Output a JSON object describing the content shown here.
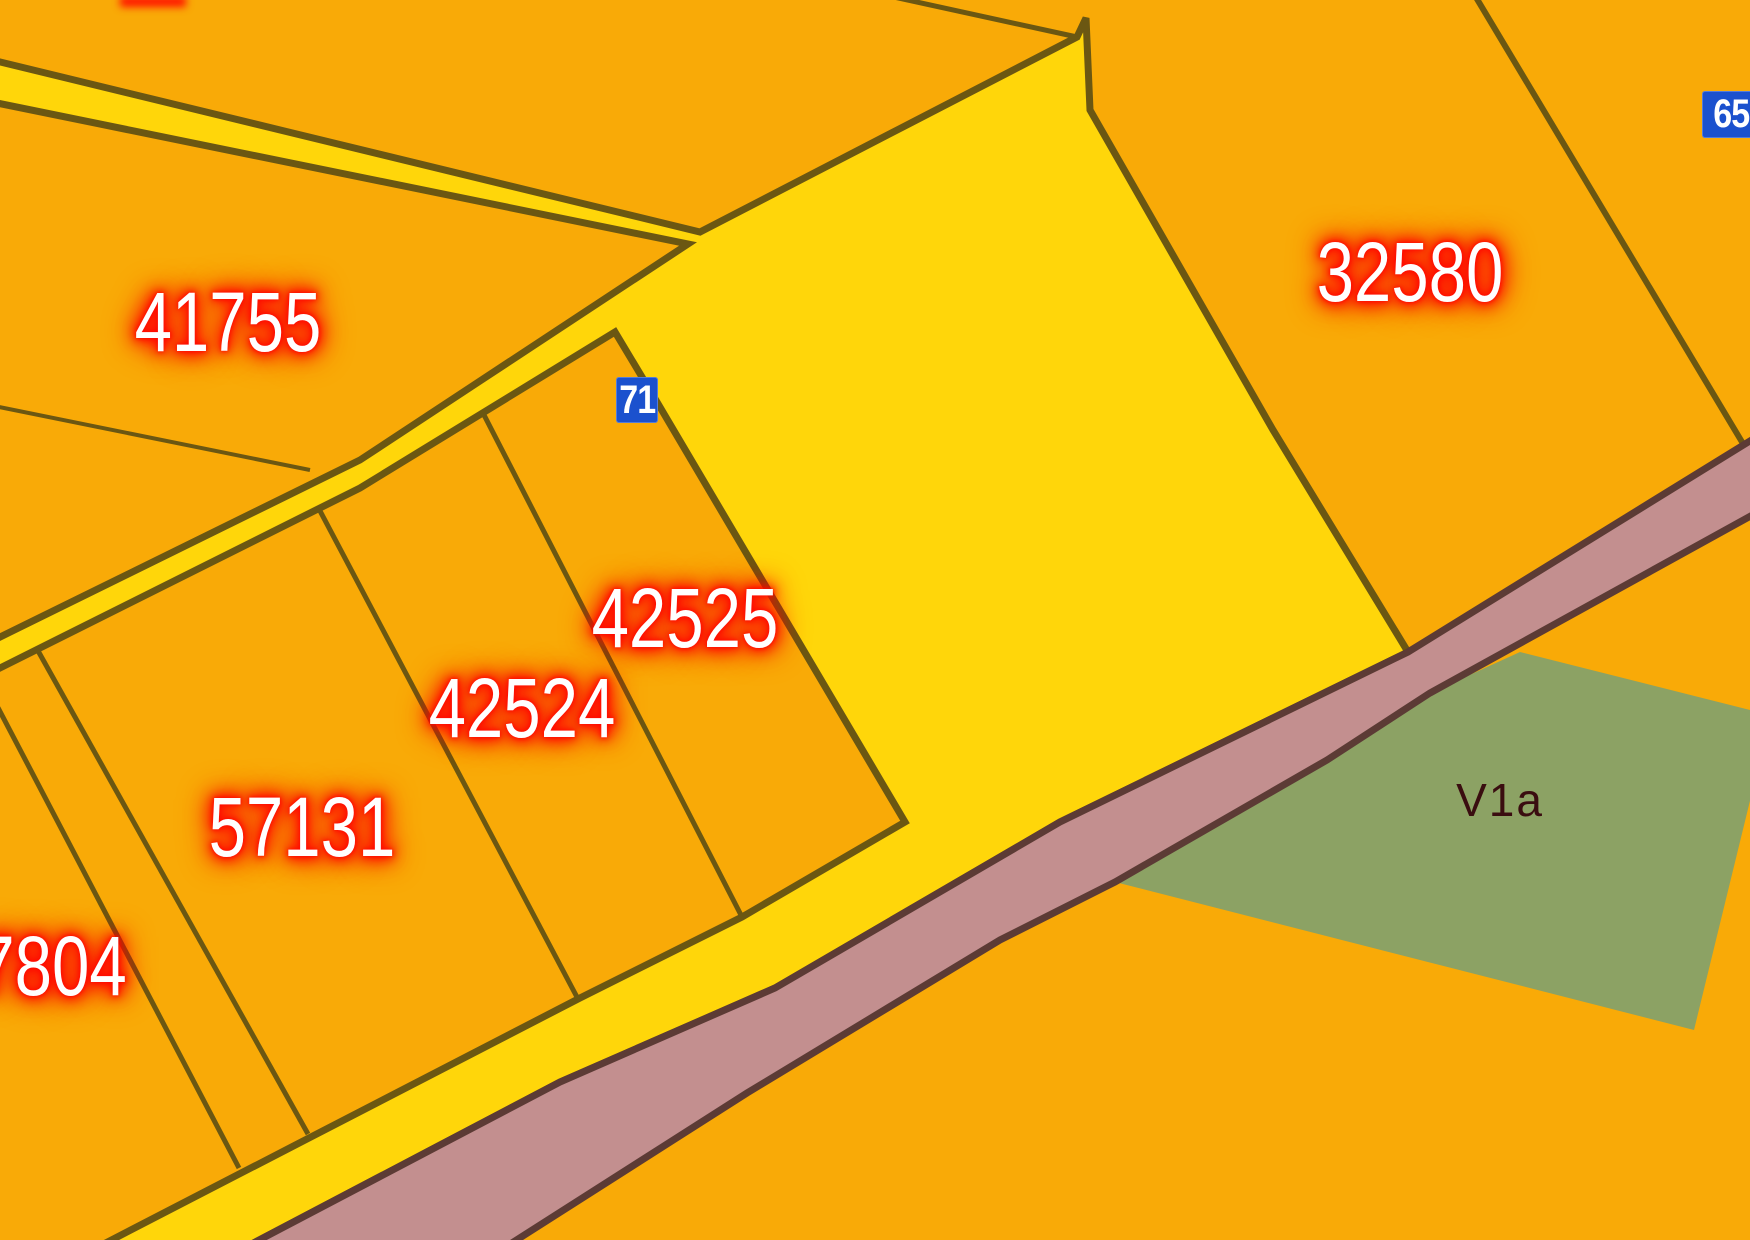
{
  "map": {
    "parcels": [
      {
        "id": "41755"
      },
      {
        "id": "32580"
      },
      {
        "id": "42525"
      },
      {
        "id": "42524"
      },
      {
        "id": "57131"
      },
      {
        "id": "7804"
      }
    ],
    "zones": [
      {
        "id": "V1a"
      }
    ],
    "road_markers": [
      {
        "number": "71"
      },
      {
        "number": "65"
      }
    ],
    "colors": {
      "parcel_orange": "#F9AA07",
      "road_yellow": "#FFD60A",
      "road_mauve": "#C38F8F",
      "zone_green": "#8CA264",
      "parcel_border": "#6B5712",
      "mauve_road_border": "#5C3B35",
      "label_text": "#FFFFFF",
      "label_glow": "#FF0800",
      "zone_label_text": "#3A0D10",
      "marker_blue": "#1B51CE",
      "marker_text": "#FFFFFF"
    }
  }
}
